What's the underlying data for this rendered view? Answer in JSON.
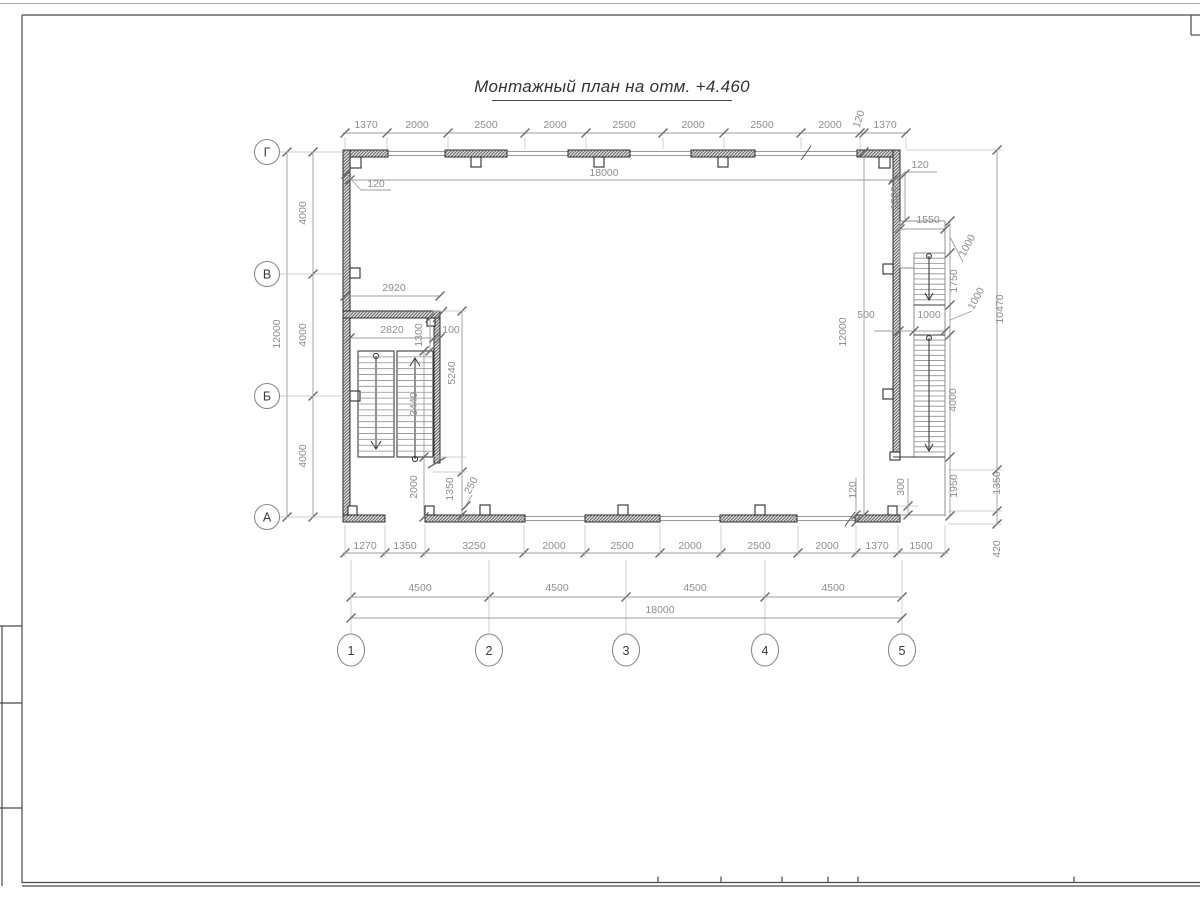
{
  "page": {
    "title": "Монтажный план на отм. +4.460"
  },
  "axes": {
    "cols": [
      "1",
      "2",
      "3",
      "4",
      "5"
    ],
    "rows": [
      "Г",
      "В",
      "Б",
      "А"
    ]
  },
  "dims": {
    "top": [
      "1370",
      "2000",
      "2500",
      "2000",
      "2500",
      "2000",
      "2500",
      "2000",
      "120",
      "1370"
    ],
    "top_inner_total": "18000",
    "left_spans": [
      "4000",
      "4000",
      "4000"
    ],
    "left_total": "12000",
    "right_inner_total": "12000",
    "left_wall_thickness": "120",
    "right_wall_thickness": "120",
    "bottom_wall_thickness": "120",
    "bottom_row1": [
      "1270",
      "1350",
      "3250",
      "2000",
      "2500",
      "2000",
      "2500",
      "2000",
      "1370",
      "1500"
    ],
    "bottom_row2": [
      "4500",
      "4500",
      "4500",
      "4500"
    ],
    "bottom_total": "18000",
    "stairwell": {
      "outer_width": "2920",
      "inner_width": "2820",
      "wall": "100",
      "offset_top": "1300",
      "flight_length": "3440",
      "overall": "5240",
      "to_wall": "2000",
      "door_offset": "1350",
      "jamb": "250"
    },
    "ext_stair": {
      "landing_width": "1550",
      "top_offset": "1500",
      "landing_top": "1000",
      "flight1": "1750",
      "landing_mid": "1000",
      "flight2": "4000",
      "exit": "1950",
      "overall": "10470",
      "offset_500": "500",
      "width_1000": "1000",
      "step_300": "300",
      "out_1350": "1350",
      "out_420": "420"
    }
  }
}
